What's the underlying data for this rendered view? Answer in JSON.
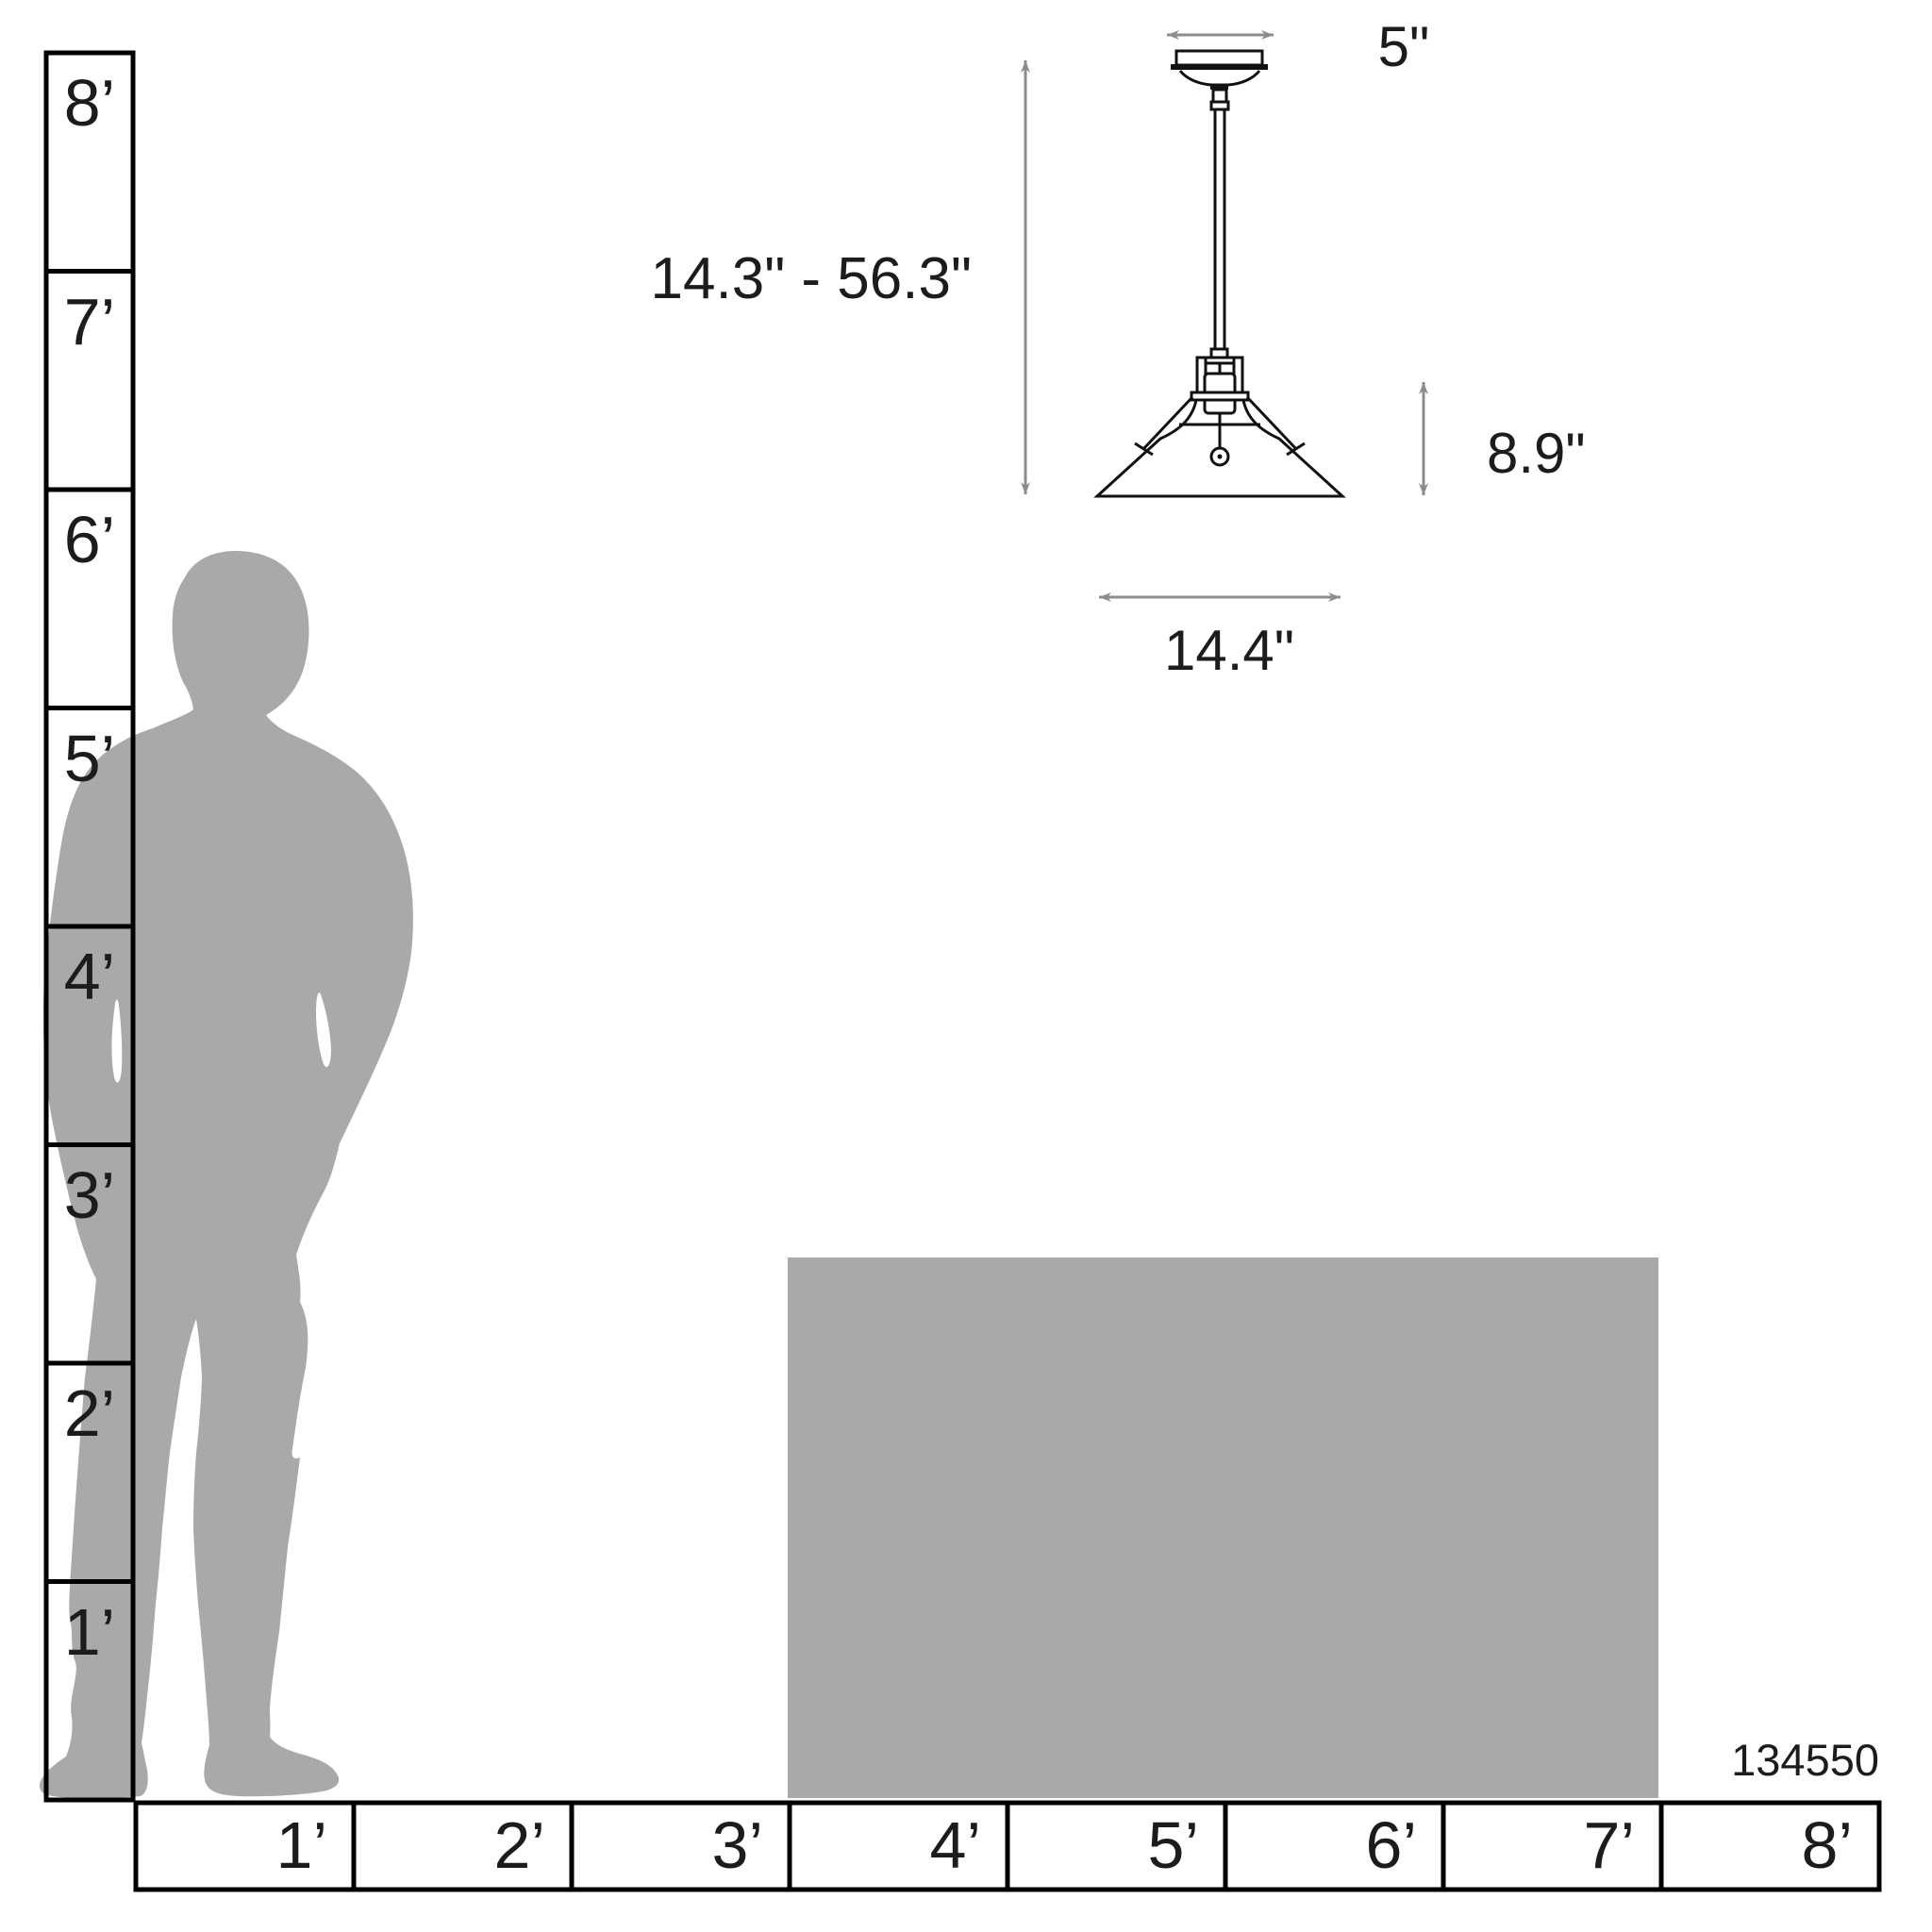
{
  "title": "Pendant light scale diagram",
  "product_code": "134550",
  "vertical_ruler": {
    "unit": "feet",
    "labels": [
      "8’",
      "7’",
      "6’",
      "5’",
      "4’",
      "3’",
      "2’",
      "1’"
    ]
  },
  "horizontal_ruler": {
    "unit": "feet",
    "labels": [
      "1’",
      "2’",
      "3’",
      "4’",
      "5’",
      "6’",
      "7’",
      "8’"
    ]
  },
  "fixture_dimensions": {
    "canopy_width": "5\"",
    "hanging_height_range": "14.3\" - 56.3\"",
    "shade_height": "8.9\"",
    "shade_diameter": "14.4\""
  },
  "icons": {
    "person_silhouette": "standing-man-silhouette",
    "table_block": "table-scale-block",
    "pendant_drawing": "pendant-light-line-drawing",
    "dimension_arrows": "double-headed-measure-arrows"
  },
  "colors": {
    "silhouette": "#a9a9a9",
    "table": "#a9a9a9",
    "arrow": "#8c8c8c",
    "line_art": "#111111",
    "ruler_line": "#000000",
    "text": "#1c1c1c",
    "background": "#ffffff"
  }
}
